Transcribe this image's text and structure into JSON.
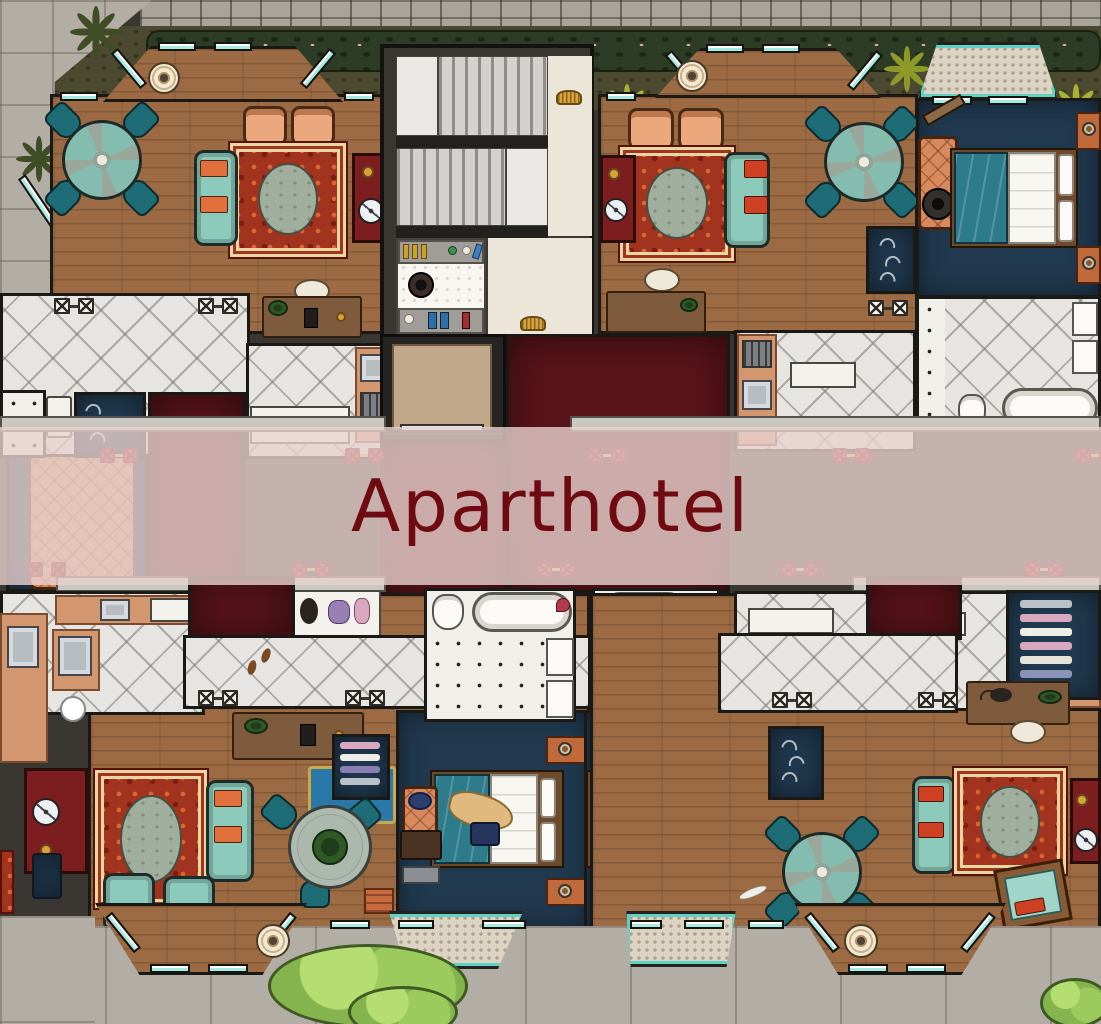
{
  "title": "Aparthotel",
  "colors": {
    "wall": "#3a3631",
    "frame": "#1b1915",
    "wood": "#9c6b44",
    "navy": "#20394f",
    "maroon": "#591419",
    "marble": "#e6e5e1",
    "stone-wall": "#a8a49a",
    "pavement": "#b3aea5",
    "garden-soil": "#4b4a31",
    "hedge": "#2d3c24",
    "palm-yellow": "#a9b232",
    "palm-dark": "#3e4d24",
    "bush-green": "#85b44f",
    "counter-salmon": "#d2976e",
    "couch-teal": "#8ccabb",
    "chair-teal-dark": "#1e6d76",
    "armchair-orange": "#eca87d",
    "pillow-orange": "#e2703d",
    "pillow-red": "#cf4123",
    "rug-red": "#a2331f",
    "rug-cream": "#e7d7a2",
    "rug-oval": "#a0af9d",
    "cabinet-red": "#7c1d20",
    "bed-teal": "#2e7b8b",
    "window-teal": "#a7ebe4",
    "balcony-trim": "#5fd2c6",
    "balcony-stone": "#ddd3c2",
    "elevator-cab": "#c1a88b",
    "banner-overlay": "rgba(233,210,208,0.8)",
    "title-red": "#6e0a10",
    "marker-red": "#d12b23",
    "gold": "#d8a23c",
    "ottoman-blue": "#2978a8",
    "desk-brown": "#7e5b3d"
  },
  "map": {
    "kind": "top-down aparthotel floor plan battlemap",
    "environment": {
      "top": "stone block wall with flowering hedge and yellow-green palms",
      "top_left": "cobblestone pavement with dark palms",
      "top_right": "stone balcony with teal trim",
      "bottom": "paved terrace with large tiles, green bushes, two stone balconies and two bay windows"
    },
    "core": {
      "stairwell": "double-flight stair with landings",
      "elevator": "single tan cab with dark shaft frame",
      "corridor": "dark red carpeted corridor",
      "utility_room": "hex-tile store room with supply shelves and pot"
    },
    "apartments": [
      {
        "id": "top-left",
        "rooms": [
          "living-dining room",
          "side settee nook",
          "kitchen",
          "marble hall",
          "bathroom",
          "closet",
          "red entry"
        ],
        "furniture": [
          "round dining table with 4 teal chairs",
          "2 orange armchairs",
          "red oriental rug with grey oval medallion",
          "teal sofa with orange cushions",
          "red display cabinet with clock",
          "writing desk with white chair",
          "orange tufted settee",
          "kitchen counter with sink and stove",
          "ceiling light in bay window"
        ]
      },
      {
        "id": "top-right",
        "rooms": [
          "living-dining room",
          "bedroom",
          "kitchen",
          "marble bathroom",
          "closet",
          "red entry"
        ],
        "furniture": [
          "round dining table with 4 teal chairs",
          "2 orange armchairs",
          "red oriental rug with grey oval medallion",
          "teal sofa with red cushions",
          "red display cabinet with clock",
          "writing desk with white chair",
          "double bed with teal blanket and white linens",
          "2 nightstands with lamps",
          "bench with duffel bag",
          "bathtub",
          "toilet",
          "twin wall sinks"
        ]
      },
      {
        "id": "bottom-left",
        "rooms": [
          "living room",
          "bedroom",
          "kitchen",
          "marble hall",
          "bathroom",
          "laundry closet",
          "red entry"
        ],
        "furniture": [
          "red oriental rug with grey oval medallion",
          "teal sofa with orange cushions",
          "2 teal armchairs",
          "glass table with potted plant and 3 chairs",
          "red display cabinet with clock",
          "desk with green lamp",
          "blue ottoman",
          "wardrobe with clothes",
          "double bed with teal blanket, thrown coat and handbag",
          "2 nightstands with lamps",
          "luggage rack, suitcase and hat",
          "bathtub",
          "toilet",
          "twin sinks",
          "kitchen counters with two sinks and range"
        ]
      },
      {
        "id": "bottom-right",
        "rooms": [
          "living room",
          "bedroom",
          "side settee nook",
          "kitchen",
          "marble hall",
          "bathroom",
          "wardrobe",
          "red entry"
        ],
        "furniture": [
          "red oriental rug with grey oval medallion",
          "teal sofa with red cushions",
          "round dining table with 4 teal chairs",
          "red display cabinet with clock",
          "desk with green lamp and cat",
          "tilted cot with red pillow",
          "orange tufted settee",
          "double bed with teal blanket",
          "2 nightstands with lamps",
          "wardrobe with hanging clothes",
          "bathtub",
          "toilet",
          "twin sinks"
        ]
      }
    ],
    "markers": {
      "description": "paired red boxed-X door markers joined by tan links along the corridor band",
      "pairs": 10,
      "rows": [
        {
          "y": 448,
          "x": [
            100,
            345,
            588,
            832,
            1076
          ]
        },
        {
          "y": 562,
          "x": [
            28,
            292,
            537,
            781,
            1025
          ]
        }
      ]
    },
    "vents": "paired white boxed-X floor vents in tiled halls",
    "banner": "translucent rose band across the middle bearing the map title"
  }
}
